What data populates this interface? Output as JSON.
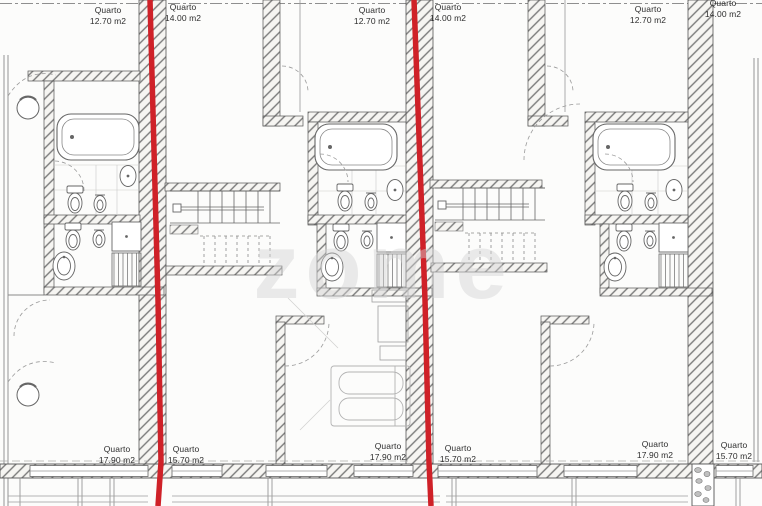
{
  "watermark": "zome",
  "colors": {
    "boundary_red": "#cf2128",
    "wall": "#6f6f6f",
    "watermark_fill": "rgba(210,210,210,0.45)"
  },
  "rooms": {
    "top": [
      {
        "name": "Quarto",
        "area": "12.70 m2"
      },
      {
        "name": "Quarto",
        "area": "14.00 m2"
      },
      {
        "name": "Quarto",
        "area": "12.70 m2"
      },
      {
        "name": "Quarto",
        "area": "14.00 m2"
      },
      {
        "name": "Quarto",
        "area": "12.70 m2"
      },
      {
        "name": "Quarto",
        "area": "14.00 m2"
      }
    ],
    "bottom": [
      {
        "name": "Quarto",
        "area": "17.90 m2"
      },
      {
        "name": "Quarto",
        "area": "15.70 m2"
      },
      {
        "name": "Quarto",
        "area": "17.90 m2"
      },
      {
        "name": "Quarto",
        "area": "15.70 m2"
      },
      {
        "name": "Quarto",
        "area": "17.90 m2"
      },
      {
        "name": "Quarto",
        "area": "15.70 m2"
      }
    ]
  }
}
